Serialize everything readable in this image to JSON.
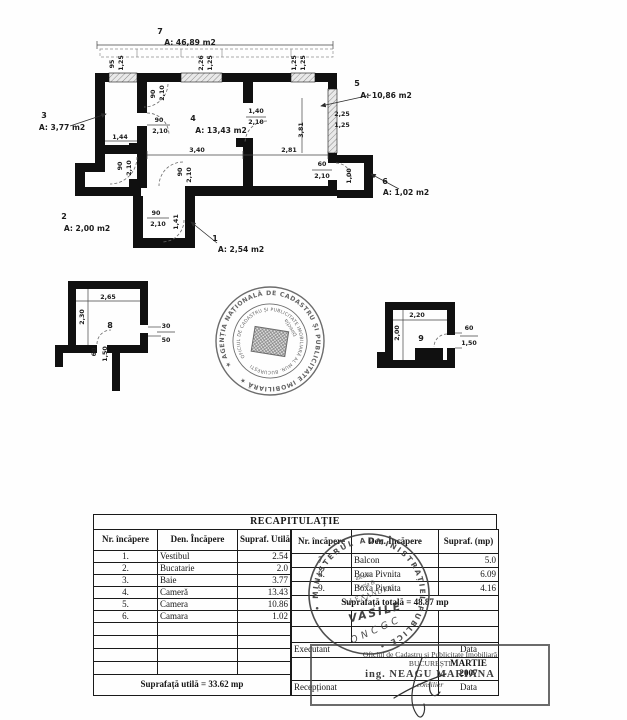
{
  "colors": {
    "wall": "#101010",
    "ink": "#1c1c1c",
    "stamp_gray": "#4a4a4a"
  },
  "plan": {
    "annotations": [
      {
        "t": "7",
        "x": 160,
        "y": 34,
        "k": "num"
      },
      {
        "t": "A: 46,89 m2",
        "x": 190,
        "y": 45,
        "k": "area"
      },
      {
        "t": "95",
        "x": 114,
        "y": 64,
        "r": -90
      },
      {
        "t": "1,25",
        "x": 123,
        "y": 63,
        "r": -90
      },
      {
        "t": "2,26",
        "x": 203,
        "y": 63,
        "r": -90
      },
      {
        "t": "1,25",
        "x": 212,
        "y": 63,
        "r": -90
      },
      {
        "t": "1,25",
        "x": 296,
        "y": 63,
        "r": -90
      },
      {
        "t": "1,25",
        "x": 305,
        "y": 63,
        "r": -90
      },
      {
        "t": "90",
        "x": 155,
        "y": 94,
        "r": -90
      },
      {
        "t": "2,10",
        "x": 164,
        "y": 93,
        "r": -90
      },
      {
        "t": "3",
        "x": 44,
        "y": 118,
        "k": "num"
      },
      {
        "t": "A: 3,77 m2",
        "x": 62,
        "y": 130,
        "k": "area"
      },
      {
        "t": "90",
        "x": 159,
        "y": 122
      },
      {
        "t": "2,10",
        "x": 160,
        "y": 133
      },
      {
        "t": "1,44",
        "x": 120,
        "y": 139
      },
      {
        "t": "4",
        "x": 193,
        "y": 121,
        "k": "num"
      },
      {
        "t": "A: 13,43 m2",
        "x": 221,
        "y": 133,
        "k": "area"
      },
      {
        "t": "1,40",
        "x": 256,
        "y": 113
      },
      {
        "t": "2,10",
        "x": 256,
        "y": 124
      },
      {
        "t": "5",
        "x": 357,
        "y": 86,
        "k": "num"
      },
      {
        "t": "A: 10,86 m2",
        "x": 386,
        "y": 98,
        "k": "area"
      },
      {
        "t": "2,25",
        "x": 342,
        "y": 116
      },
      {
        "t": "1,25",
        "x": 342,
        "y": 127
      },
      {
        "t": "3,81",
        "x": 303,
        "y": 130,
        "r": -90
      },
      {
        "t": "3,40",
        "x": 197,
        "y": 152
      },
      {
        "t": "2,81",
        "x": 289,
        "y": 152
      },
      {
        "t": "90",
        "x": 122,
        "y": 166,
        "r": -90
      },
      {
        "t": "2,10",
        "x": 131,
        "y": 168,
        "r": -90
      },
      {
        "t": "90",
        "x": 182,
        "y": 172,
        "r": -90
      },
      {
        "t": "2,10",
        "x": 191,
        "y": 175,
        "r": -90
      },
      {
        "t": "60",
        "x": 322,
        "y": 166
      },
      {
        "t": "2,10",
        "x": 322,
        "y": 178
      },
      {
        "t": "1,00",
        "x": 351,
        "y": 176,
        "r": -90
      },
      {
        "t": "6",
        "x": 385,
        "y": 184,
        "k": "num"
      },
      {
        "t": "A: 1,02 m2",
        "x": 406,
        "y": 195,
        "k": "area"
      },
      {
        "t": "2",
        "x": 64,
        "y": 219,
        "k": "num"
      },
      {
        "t": "A: 2,00 m2",
        "x": 87,
        "y": 231,
        "k": "area"
      },
      {
        "t": "90",
        "x": 156,
        "y": 215
      },
      {
        "t": "2,10",
        "x": 158,
        "y": 226
      },
      {
        "t": "1,41",
        "x": 178,
        "y": 222,
        "r": -90
      },
      {
        "t": "1",
        "x": 215,
        "y": 241,
        "k": "num"
      },
      {
        "t": "A: 2,54 m2",
        "x": 241,
        "y": 252,
        "k": "area"
      },
      {
        "t": "2,65",
        "x": 108,
        "y": 299
      },
      {
        "t": "2,30",
        "x": 84,
        "y": 317,
        "r": -90
      },
      {
        "t": "8",
        "x": 110,
        "y": 328,
        "k": "num"
      },
      {
        "t": "30",
        "x": 166,
        "y": 328
      },
      {
        "t": "50",
        "x": 166,
        "y": 342
      },
      {
        "t": "60",
        "x": 96,
        "y": 352,
        "r": -90
      },
      {
        "t": "1,50",
        "x": 107,
        "y": 354,
        "r": -90
      },
      {
        "t": "2,20",
        "x": 417,
        "y": 317
      },
      {
        "t": "2,00",
        "x": 399,
        "y": 333,
        "r": -90
      },
      {
        "t": "9",
        "x": 421,
        "y": 341,
        "k": "num"
      },
      {
        "t": "60",
        "x": 469,
        "y": 330
      },
      {
        "t": "1,50",
        "x": 469,
        "y": 345
      }
    ]
  },
  "stamps": {
    "central": {
      "outer": "★ AGENȚIA NAȚIONALĂ DE CADASTRU ȘI PUBLICITATE IMOBILIARĂ ★",
      "inner": "OFICIUL DE CADASTRU ȘI PUBLICITATE IMOBILIARĂ AL MUN. BUCUREȘTI",
      "dir": "Direcția"
    },
    "ministry": {
      "ring": "• MINISTERUL ADMINISTRAȚIEI PUBLICE •",
      "line1": "atestat",
      "line2": "Seria B",
      "line3": "ALEXANDRU",
      "hand1": "VASILE",
      "hand2": "ONCGC"
    },
    "office": {
      "line1": "Oficiul de Cadastru și Publicitate Imobiliară",
      "line2": "BUCUREȘTI",
      "line3": "ing. NEAGU MARIANA",
      "line4": "consilier"
    }
  },
  "table": {
    "title": "RECAPITULAȚIE",
    "headers_left": [
      "Nr. încăpere",
      "Den. Încăpere",
      "Supraf. Utilă (mp)"
    ],
    "headers_right": [
      "Nr. încăpere",
      "Den. Încăpere",
      "Supraf. (mp)"
    ],
    "rows_left": [
      [
        "1.",
        "Vestibul",
        "2.54"
      ],
      [
        "2.",
        "Bucatarie",
        "2.0"
      ],
      [
        "3.",
        "Baie",
        "3.77"
      ],
      [
        "4.",
        "Cameră",
        "13.43"
      ],
      [
        "5.",
        "Camera",
        "10.86"
      ],
      [
        "6.",
        "Camara",
        "1.02"
      ]
    ],
    "rows_right": [
      [
        "7.",
        "Balcon",
        "5.0"
      ],
      [
        "8.",
        "Boxa Pivnita",
        "6.09"
      ],
      [
        "9.",
        "Boxa Pivnita",
        "4.16"
      ]
    ],
    "total_line": "Suprafață totală = 48.87 mp",
    "executant": "Executant",
    "data_label": "Data",
    "date_month": "MARTIE",
    "date_year": "2007",
    "receptionat": "Recepționat",
    "data_label2": "Data",
    "footer": "Suprafață utilă = 33.62 mp"
  }
}
